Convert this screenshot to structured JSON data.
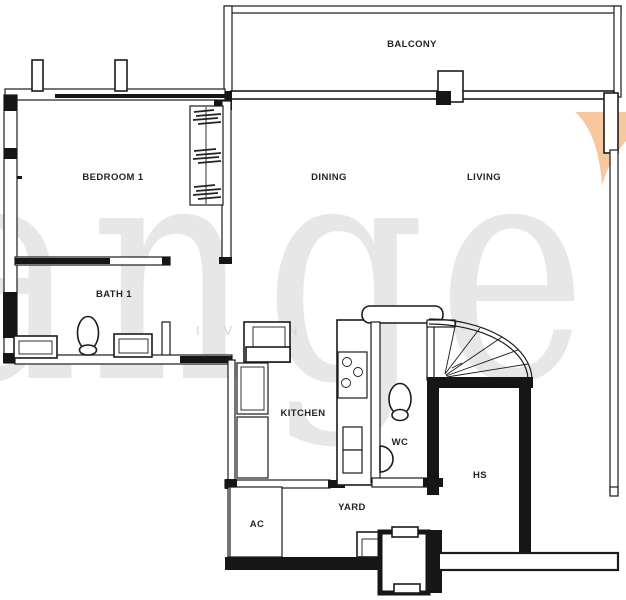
{
  "floorplan": {
    "rooms": {
      "balcony": "BALCONY",
      "bedroom1": "BEDROOM 1",
      "dining": "DINING",
      "living": "LIVING",
      "bath1": "BATH 1",
      "kitchen": "KITCHEN",
      "wc": "WC",
      "hs": "HS",
      "yard": "YARD",
      "ac": "AC"
    },
    "watermark": {
      "large_text": "ange",
      "agent_text": "IVAN",
      "text_color": "#d9d9d9",
      "accent_color": "#f7c79d"
    },
    "line_color": "#1b1b1b"
  }
}
